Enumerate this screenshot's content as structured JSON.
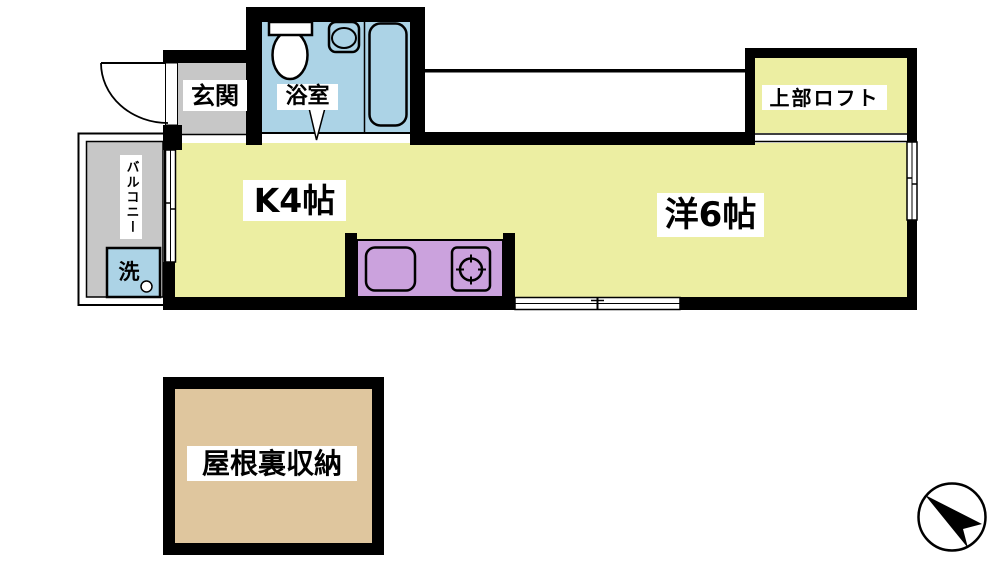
{
  "floorplan": {
    "rooms": {
      "entrance": {
        "label": "玄関"
      },
      "bathroom": {
        "label": "浴室"
      },
      "kitchen": {
        "label": "K4帖"
      },
      "western_room": {
        "label": "洋6帖"
      },
      "loft": {
        "label": "上部ロフト"
      },
      "balcony": {
        "label": "バルコニー"
      },
      "washing_machine": {
        "label": "洗"
      },
      "attic_storage": {
        "label": "屋根裏収納"
      }
    },
    "fixtures": [
      "toilet",
      "wash-basin",
      "bathtub",
      "kitchen-sink",
      "gas-stove",
      "washing-machine",
      "entrance-door"
    ],
    "compass": {
      "type": "north-arrow-in-circle",
      "pointing": "upper-left"
    },
    "colors": {
      "room_yellow": "#eceea2",
      "wet_area_blue": "#acd3e6",
      "hall_gray": "#c7c7c7",
      "counter_purple": "#cba2dd",
      "attic_tan": "#dfc69e",
      "wall_black": "#000000",
      "background_white": "#ffffff"
    }
  }
}
